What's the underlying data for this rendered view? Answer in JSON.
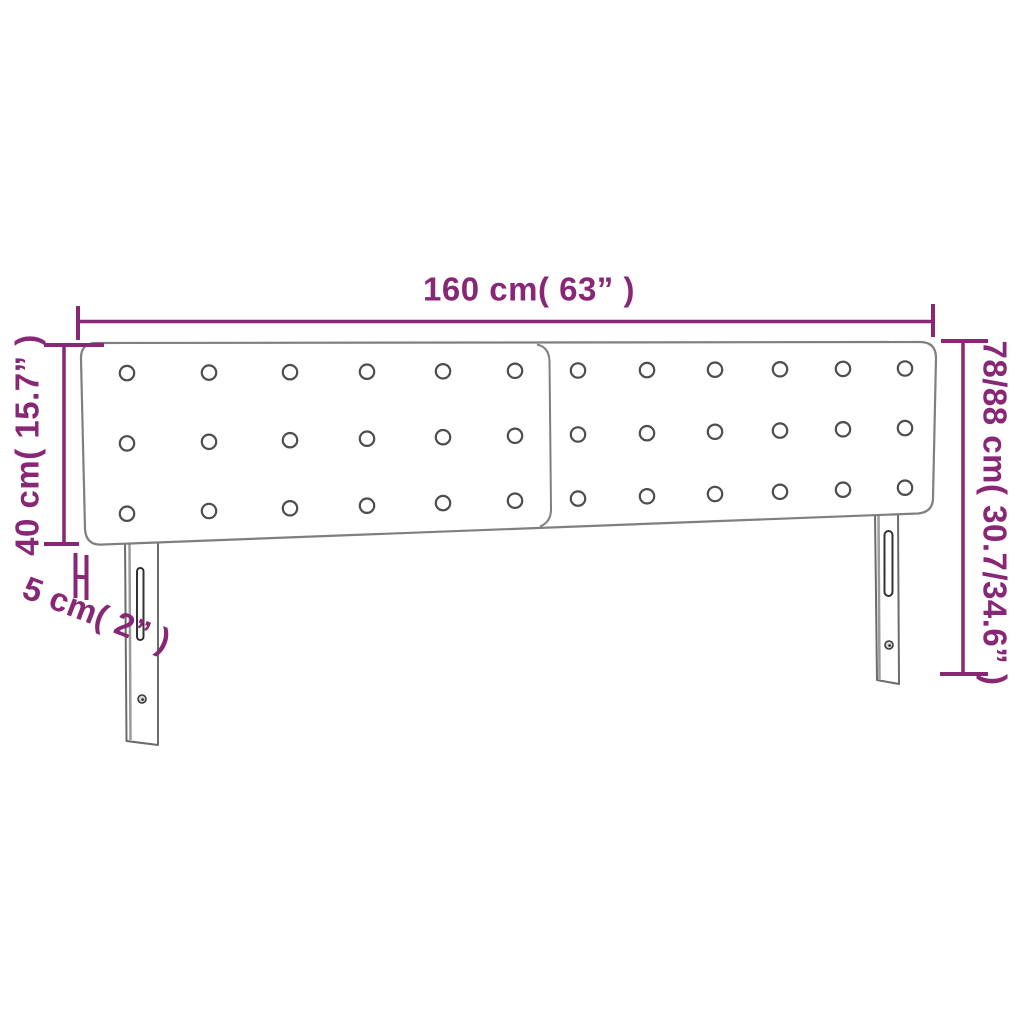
{
  "diagram": {
    "labels": {
      "width": "160 cm( 63” )",
      "panel_height": "40 cm( 15.7” )",
      "thickness": "5 cm( 2” )",
      "total_height": "78/88 cm( 30.7/34.6” )"
    },
    "colors": {
      "accent": "#882776",
      "outline": "#7f7f7f",
      "button_stroke": "#4d4d4d",
      "leg_outline": "#6b6b6b"
    },
    "tufting": {
      "panels": 2,
      "rows_per_panel": 3,
      "buttons_per_row": 6
    }
  }
}
